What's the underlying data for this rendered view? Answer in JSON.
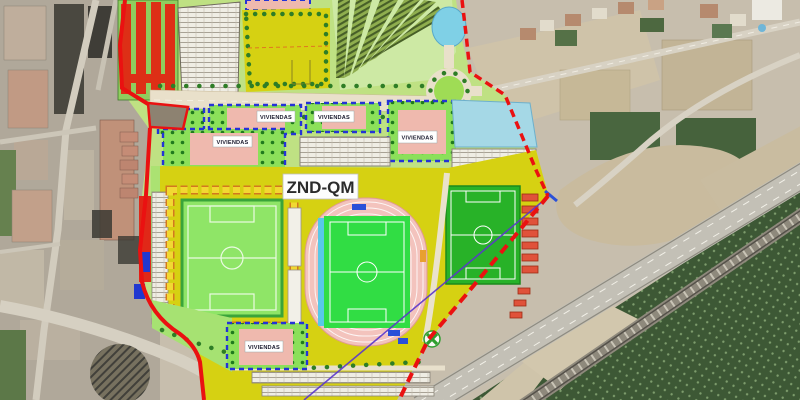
{
  "map": {
    "zone_label": "ZND-QM",
    "housing_labels": [
      "VIVIENDAS",
      "VIVIENDAS",
      "VIVIENDAS",
      "VIVIENDAS",
      "VIVIENDAS"
    ],
    "colors": {
      "boundary_red": "#e81111",
      "parcel_yellow": "#d6d112",
      "plan_light_green": "#bfe183",
      "housing_block_green": "#8ce05a",
      "housing_border_blue": "#2433d6",
      "housing_inner_pink": "#efb9ae",
      "pitch_light_green": "#8fe567",
      "pitch_bright_green": "#2db32d",
      "athletics_track_pink": "#f3c3bd",
      "pond_blue": "#7fd0e6",
      "blue_parcel": "#a5d8e6",
      "stand_red": "#e0523a"
    }
  }
}
